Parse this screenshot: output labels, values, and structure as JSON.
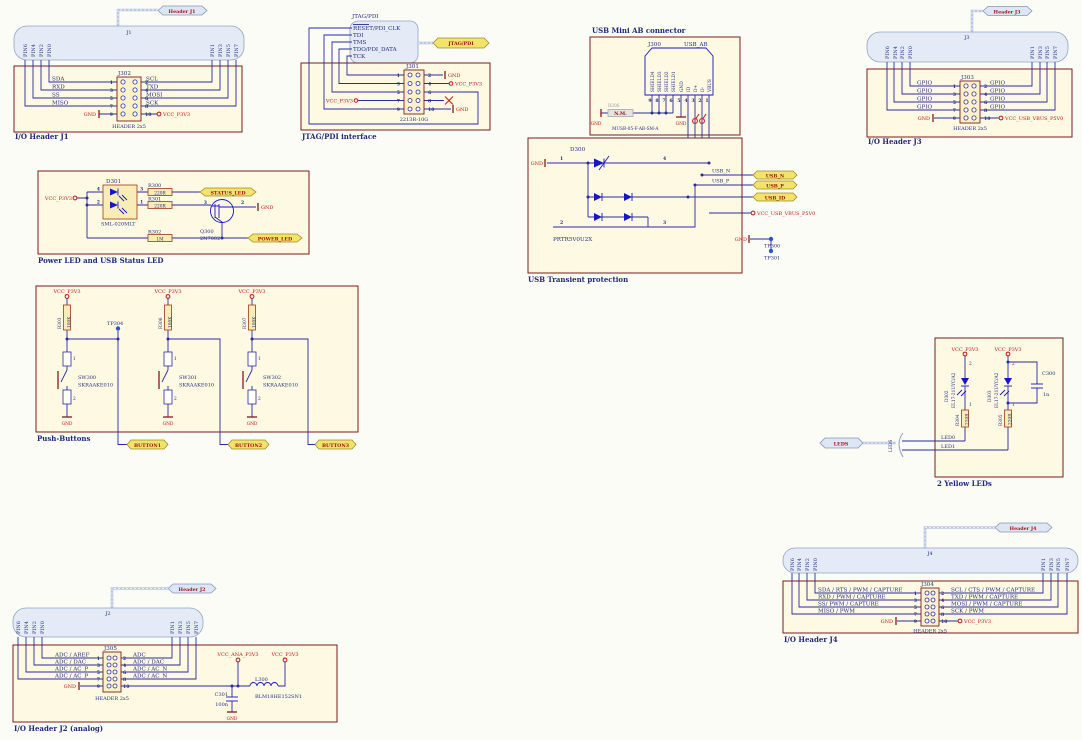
{
  "pins": {
    "l": [
      "PIN6",
      "PIN4",
      "PIN2",
      "PIN0"
    ],
    "r": [
      "PIN1",
      "PIN3",
      "PIN5",
      "PIN7"
    ]
  },
  "nums": {
    "l": [
      "1",
      "3",
      "5",
      "7",
      "9"
    ],
    "r": [
      "2",
      "4",
      "6",
      "8",
      "10"
    ]
  },
  "j1": {
    "tag": "Header J1",
    "conn": "J1",
    "ref": "J302",
    "ll": [
      "SDA",
      "RXD",
      "SS",
      "MISO"
    ],
    "lr": [
      "SCL",
      "TXD",
      "MOSI",
      "SCK"
    ],
    "gnd": "GND",
    "vcc": "VCC_P3V3",
    "part": "HEADER 2x5",
    "title": "I/O Header J1"
  },
  "jtag": {
    "bubble": "JTAG/PDI",
    "sig": [
      "RESET/PDI_CLK",
      "TDI",
      "TMS",
      "TDO/PDI_DATA",
      "TCK"
    ],
    "tag": "JTAG/PDI",
    "ref": "J301",
    "gnd2": "GND",
    "vcc4": "VCC_P3V3",
    "vcc7": "VCC_P3V3",
    "gnd10": "GND",
    "part": "2213R-10G",
    "title": "JTAG/PDI interface"
  },
  "usb": {
    "title": "USB Mini AB connector",
    "ref": "J300",
    "name": "USB_AB",
    "pinlabels": [
      "SHIELD4",
      "SHIELD3",
      "SHIELD2",
      "SHIELD1",
      "GND",
      "ID",
      "D+",
      "D-",
      "VBUS"
    ],
    "pinnums": [
      "9",
      "8",
      "7",
      "6",
      "5",
      "4",
      "3",
      "2",
      "1"
    ],
    "rref": "R306",
    "rval": "N.M.",
    "gnd1": "GND",
    "gnd2": "GND",
    "part": "MUSB-05-F-AB-SM-A"
  },
  "j3": {
    "tag": "Header J3",
    "conn": "J3",
    "ref": "J303",
    "ll": [
      "GPIO",
      "GPIO",
      "GPIO",
      "GPIO"
    ],
    "lr": [
      "GPIO",
      "GPIO",
      "GPIO",
      "GPIO"
    ],
    "gnd": "GND",
    "vcc": "VCC_USB_VBUS_P5V0",
    "part": "HEADER 2x5",
    "title": "I/O Header J3"
  },
  "led1": {
    "title": "Power LED and USB Status LED",
    "vcc": "VCC_P3V3",
    "dref": "D301",
    "dpart": "SML-020MLT",
    "p4": "4",
    "p2": "2",
    "p3": "3",
    "p1": "1",
    "r300": "R300",
    "r300v": "220R",
    "r301": "R301",
    "r301v": "220R",
    "r302": "R302",
    "r302v": "1M",
    "qref": "Q300",
    "qpart": "2N7002",
    "q3": "3",
    "q2": "2",
    "gnd": "GND",
    "status": "STATUS_LED",
    "power": "POWER_LED"
  },
  "prot": {
    "title": "USB Transient protection",
    "ref": "D300",
    "part": "PRTR5V0U2X",
    "p1": "1",
    "p2": "2",
    "p3": "3",
    "p4": "4",
    "lbl_n": "USB_N",
    "lbl_p": "USB_P",
    "tag_n": "USB_N",
    "tag_p": "USB_P",
    "tag_id": "USB_ID",
    "vbus": "VCC_USB_VBUS_P5V0",
    "gnd": "GND",
    "tp300": "TP300",
    "tp301": "TP301"
  },
  "btn": {
    "title": "Push-Buttons",
    "vcc": "VCC_P3V3",
    "tp": "TP304",
    "gnd": "GND",
    "p1": "1",
    "p2": "2",
    "cols": [
      {
        "r": "R303",
        "rv": "100K",
        "sw": "SW300",
        "part": "SKRAAKE010",
        "tag": "BUTTON1"
      },
      {
        "r": "R306",
        "rv": "100K",
        "sw": "SW301",
        "part": "SKRAAKE010",
        "tag": "BUTTON2"
      },
      {
        "r": "R307",
        "rv": "100K",
        "sw": "SW302",
        "part": "SKRAAKE010",
        "tag": "BUTTON3"
      }
    ]
  },
  "led2": {
    "title": "2 Yellow LEDs",
    "vcc": "VCC_P3V3",
    "p2": "2",
    "p1": "1",
    "cols": [
      {
        "d": "D302",
        "part": "EL17-21UYC/A2",
        "r": "R304",
        "rv": "220R"
      },
      {
        "d": "D303",
        "part": "EL17-21UYC/A2",
        "r": "R305",
        "rv": "220R"
      }
    ],
    "cref": "C300",
    "cval": "1n",
    "tag": "LEDS",
    "bracket": "LEDS",
    "n0": "LED0",
    "n1": "LED1"
  },
  "j4": {
    "tag": "Header J4",
    "conn": "J4",
    "ref": "J304",
    "ll": [
      "SDA / RTS / PWM / CAPTURE",
      "RXD / PWM / CAPTURE",
      "SS/ PWM / CAPTURE",
      "MISO / PWM"
    ],
    "lr": [
      "SCL / CTS / PWM / CAPTURE",
      "TXD / PWM / CAPTURE",
      "MOSI / PWM / CAPTURE",
      "SCK / PWM"
    ],
    "gnd": "GND",
    "vcc": "VCC_P3V3",
    "part": "HEADER 2x5",
    "title": "I/O Header J4"
  },
  "j2": {
    "tag": "Header J2",
    "conn": "J2",
    "ref": "J305",
    "ll": [
      "ADC / AREF",
      "ADC / DAC",
      "ADC / AC_P",
      "ADC / AC_P"
    ],
    "lr": [
      "ADC",
      "ADC / DAC",
      "ADC / AC_N",
      "ADC / AC_N"
    ],
    "gnd": "GND",
    "part": "HEADER 2x5",
    "title": "I/O Header J2 (analog)",
    "filt": {
      "ana": "VCC_ANA_P3V3",
      "vcc": "VCC_P3V3",
      "lref": "L300",
      "lpart": "BLM18HE152SN1",
      "cref": "C301",
      "cval": "100n",
      "gnd": "GND"
    }
  }
}
